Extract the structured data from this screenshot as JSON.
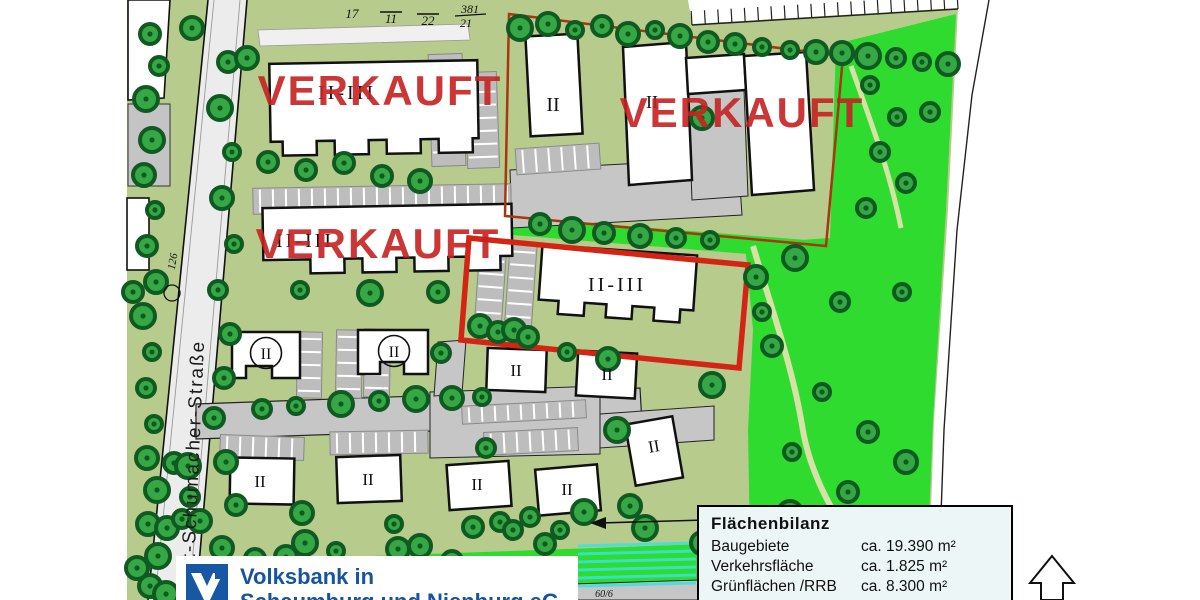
{
  "canvas": {
    "w": 1200,
    "h": 600
  },
  "labels": {
    "sold": "VERKAUFT",
    "numeral_ii": "II",
    "numeral_ii_iii": "II-III",
    "street": "Kurt-Schumacher-Straße",
    "p17": "17",
    "p11": "11",
    "p22": "22",
    "p381": "381",
    "p21": "21",
    "p126": "126",
    "p60": "60/6"
  },
  "legend": {
    "title": "Flächenbilanz",
    "rows": [
      {
        "label": "Baugebiete",
        "value": "ca. 19.390 m²"
      },
      {
        "label": "Verkehrsfläche",
        "value": "ca. 1.825 m²"
      },
      {
        "label": "Grünflächen /RRB",
        "value": "ca. 8.300 m²"
      },
      {
        "label": "Gesamt",
        "value": "ca. 29.515 m²"
      }
    ]
  },
  "branding": {
    "line1": "Volksbank in",
    "line2": "Schaumburg und Nienburg eG"
  },
  "colors": {
    "sold_red": "#c62222",
    "plot_red": "#d42414",
    "parcel_red": "#a8360f",
    "pale_green": "#b7cb8c",
    "bright_green": "#2edb2e",
    "tree_fill": "#35a845",
    "tree_ring": "#0f5a20",
    "road_gray": "#c6c6c6",
    "water_cyan": "#3ae2e2",
    "volksbank_blue": "#15549e"
  },
  "map": {
    "trees": [
      [
        150,
        34
      ],
      [
        159,
        66
      ],
      [
        146,
        99
      ],
      [
        152,
        140
      ],
      [
        144,
        175
      ],
      [
        155,
        210
      ],
      [
        147,
        246
      ],
      [
        156,
        282
      ],
      [
        143,
        316
      ],
      [
        152,
        352
      ],
      [
        146,
        388
      ],
      [
        154,
        424
      ],
      [
        147,
        458
      ],
      [
        157,
        490
      ],
      [
        148,
        524
      ],
      [
        158,
        556
      ],
      [
        150,
        586
      ],
      [
        137,
        568
      ],
      [
        166,
        594
      ],
      [
        133,
        292
      ],
      [
        228,
        62
      ],
      [
        220,
        108
      ],
      [
        232,
        152
      ],
      [
        222,
        198
      ],
      [
        234,
        244
      ],
      [
        218,
        290
      ],
      [
        230,
        334
      ],
      [
        224,
        378
      ],
      [
        214,
        418
      ],
      [
        226,
        462
      ],
      [
        236,
        505
      ],
      [
        222,
        548
      ],
      [
        233,
        585
      ],
      [
        268,
        162
      ],
      [
        306,
        170
      ],
      [
        344,
        163
      ],
      [
        382,
        176
      ],
      [
        420,
        181
      ],
      [
        300,
        290
      ],
      [
        370,
        293
      ],
      [
        438,
        292
      ],
      [
        441,
        353
      ],
      [
        192,
        28
      ],
      [
        247,
        58
      ],
      [
        520,
        28
      ],
      [
        548,
        24
      ],
      [
        575,
        30
      ],
      [
        602,
        26
      ],
      [
        628,
        34
      ],
      [
        655,
        30
      ],
      [
        680,
        36
      ],
      [
        708,
        42
      ],
      [
        735,
        44
      ],
      [
        762,
        47
      ],
      [
        790,
        50
      ],
      [
        816,
        52
      ],
      [
        842,
        53
      ],
      [
        868,
        56
      ],
      [
        896,
        58
      ],
      [
        922,
        62
      ],
      [
        948,
        64
      ],
      [
        870,
        85
      ],
      [
        897,
        117
      ],
      [
        930,
        112
      ],
      [
        880,
        152
      ],
      [
        906,
        183
      ],
      [
        866,
        208
      ],
      [
        702,
        118
      ],
      [
        540,
        224
      ],
      [
        572,
        230
      ],
      [
        604,
        233
      ],
      [
        640,
        236
      ],
      [
        676,
        238
      ],
      [
        710,
        240
      ],
      [
        480,
        326
      ],
      [
        498,
        332
      ],
      [
        514,
        330
      ],
      [
        528,
        337
      ],
      [
        567,
        352
      ],
      [
        608,
        359
      ],
      [
        712,
        385
      ],
      [
        756,
        277
      ],
      [
        762,
        312
      ],
      [
        795,
        258
      ],
      [
        840,
        302
      ],
      [
        902,
        292
      ],
      [
        772,
        346
      ],
      [
        822,
        392
      ],
      [
        868,
        432
      ],
      [
        906,
        462
      ],
      [
        792,
        452
      ],
      [
        848,
        492
      ],
      [
        898,
        522
      ],
      [
        262,
        409
      ],
      [
        296,
        406
      ],
      [
        341,
        404
      ],
      [
        379,
        401
      ],
      [
        416,
        399
      ],
      [
        452,
        398
      ],
      [
        482,
        397
      ],
      [
        174,
        463
      ],
      [
        188,
        466
      ],
      [
        167,
        528
      ],
      [
        182,
        519
      ],
      [
        200,
        521
      ],
      [
        486,
        448
      ],
      [
        617,
        430
      ],
      [
        500,
        522
      ],
      [
        530,
        517
      ],
      [
        560,
        530
      ],
      [
        190,
        497
      ],
      [
        302,
        513
      ],
      [
        305,
        543
      ],
      [
        336,
        551
      ],
      [
        394,
        524
      ],
      [
        398,
        549
      ],
      [
        473,
        527
      ],
      [
        513,
        530
      ],
      [
        545,
        544
      ],
      [
        584,
        512
      ],
      [
        630,
        506
      ],
      [
        645,
        528
      ],
      [
        702,
        543
      ],
      [
        790,
        513
      ],
      [
        860,
        526
      ],
      [
        886,
        529
      ],
      [
        908,
        533
      ],
      [
        946,
        543
      ],
      [
        868,
        566
      ],
      [
        255,
        559
      ],
      [
        286,
        557
      ],
      [
        322,
        584
      ],
      [
        420,
        546
      ],
      [
        452,
        561
      ]
    ],
    "parking": [
      {
        "x": 430,
        "y": 54,
        "w": 34,
        "h": 112,
        "dir": "h",
        "rot": -2
      },
      {
        "x": 466,
        "y": 72,
        "w": 32,
        "h": 96,
        "dir": "h",
        "rot": -2
      },
      {
        "x": 253,
        "y": 186,
        "w": 258,
        "h": 26,
        "dir": "v",
        "rot": -1
      },
      {
        "x": 477,
        "y": 241,
        "w": 27,
        "h": 92,
        "dir": "h",
        "rot": 4
      },
      {
        "x": 507,
        "y": 245,
        "w": 27,
        "h": 88,
        "dir": "h",
        "rot": 4
      },
      {
        "x": 297,
        "y": 332,
        "w": 25,
        "h": 66,
        "dir": "h",
        "rot": 1
      },
      {
        "x": 336,
        "y": 330,
        "w": 26,
        "h": 68,
        "dir": "h",
        "rot": 1
      },
      {
        "x": 364,
        "y": 329,
        "w": 26,
        "h": 68,
        "dir": "h",
        "rot": 1
      },
      {
        "x": 220,
        "y": 436,
        "w": 84,
        "h": 23,
        "dir": "v",
        "rot": 2
      },
      {
        "x": 330,
        "y": 431,
        "w": 98,
        "h": 23,
        "dir": "v",
        "rot": -1
      },
      {
        "x": 462,
        "y": 403,
        "w": 124,
        "h": 18,
        "dir": "v",
        "rot": -3
      },
      {
        "x": 484,
        "y": 430,
        "w": 94,
        "h": 23,
        "dir": "v",
        "rot": -3
      },
      {
        "x": 516,
        "y": 146,
        "w": 84,
        "h": 26,
        "dir": "v",
        "rot": -4
      }
    ],
    "comb": {
      "x1": 692,
      "y1": 25,
      "x2": 958,
      "y2": 9,
      "n": 20,
      "len": 14
    },
    "water": {
      "x": 578,
      "y": 546,
      "w": 118,
      "h": 42,
      "gap": 8,
      "lw": 3
    }
  }
}
